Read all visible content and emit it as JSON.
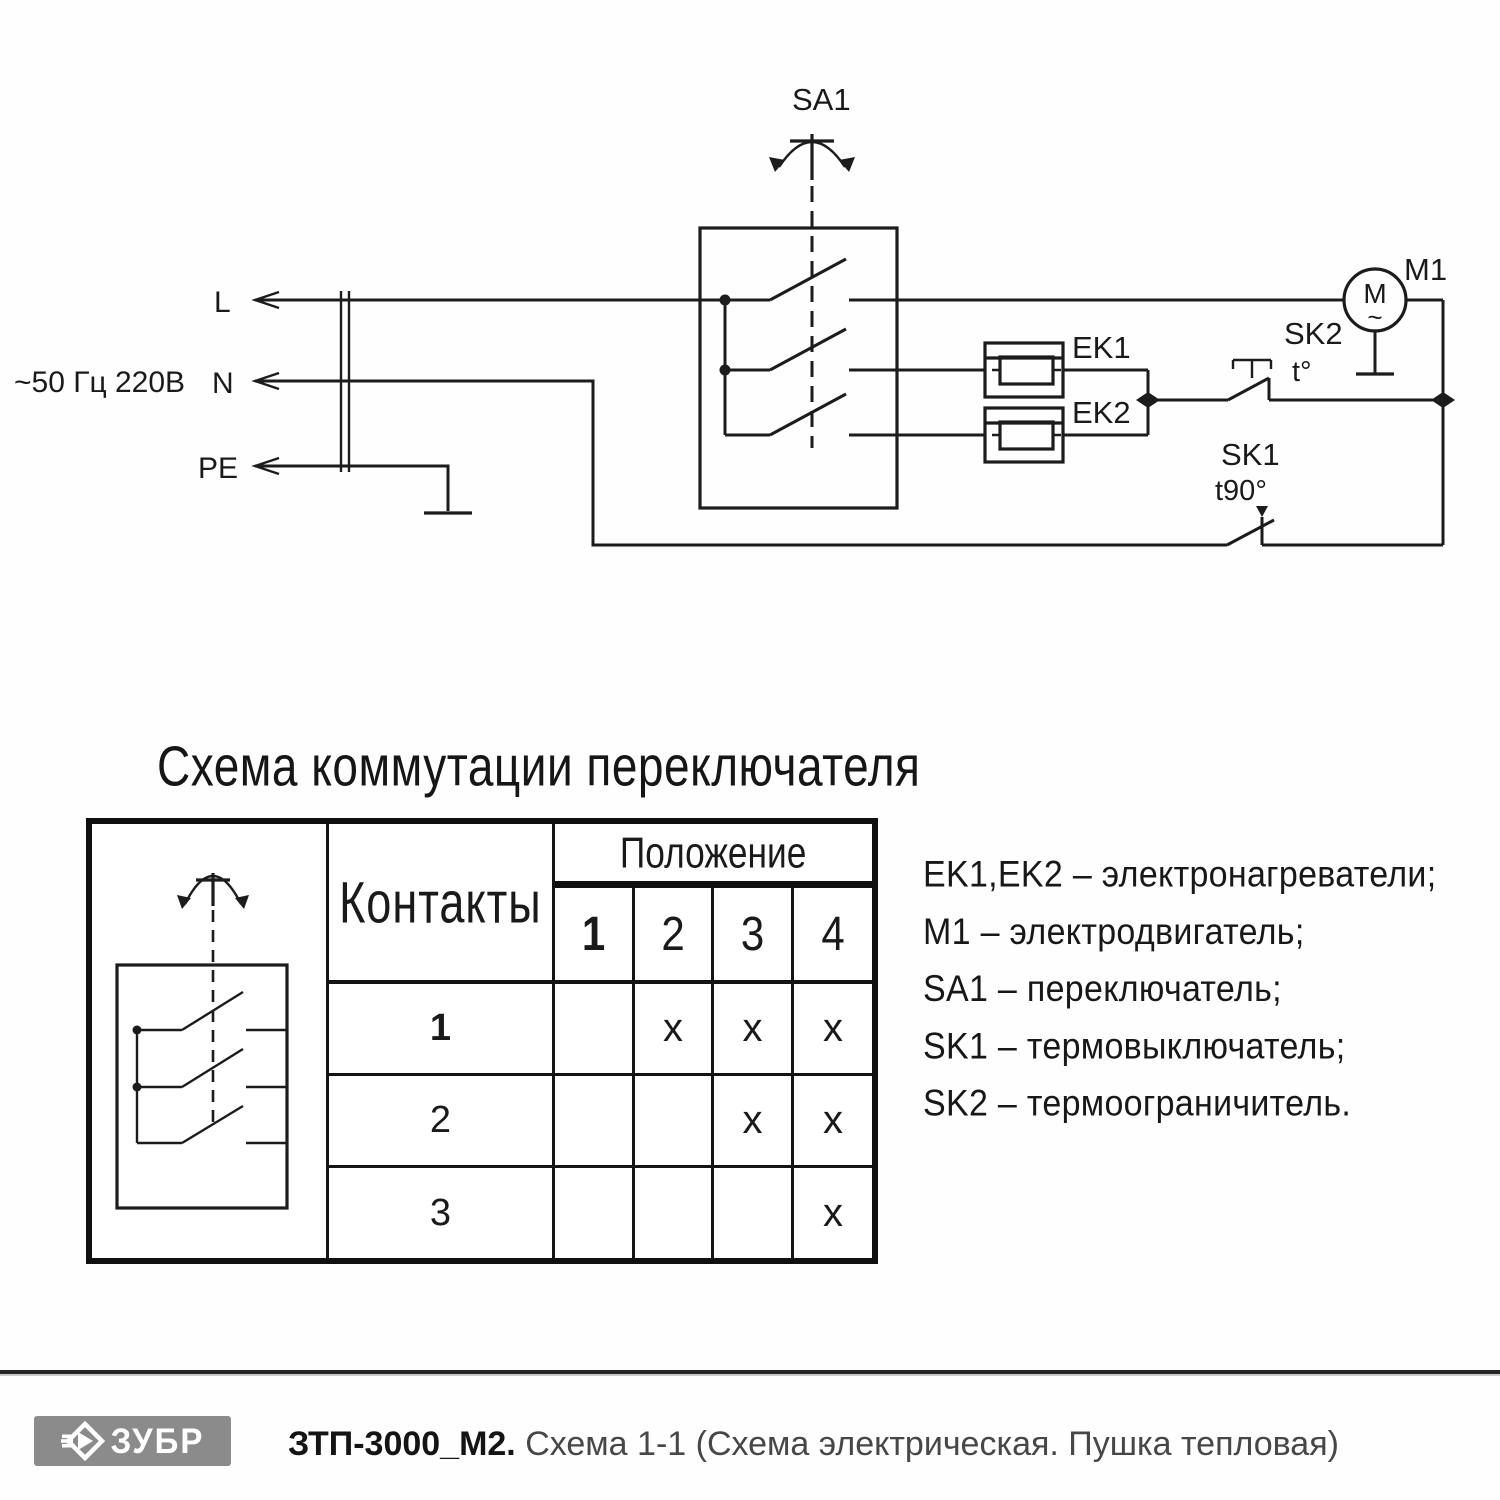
{
  "schematic": {
    "supply_label": "~50 Гц 220В",
    "terminals": {
      "l": "L",
      "n": "N",
      "pe": "PE"
    },
    "switch": {
      "label": "SA1"
    },
    "heaters": {
      "ek1": "EK1",
      "ek2": "EK2"
    },
    "motor": {
      "label": "M1",
      "symbol": "M",
      "wave": "~"
    },
    "thermal_limiter": {
      "label": "SK2",
      "temp": "t°"
    },
    "thermal_cutout": {
      "label": "SK1",
      "temp": "t90°"
    }
  },
  "switch_table": {
    "title": "Схема коммутации переключателя",
    "contacts_header": "Контакты",
    "position_header": "Положение",
    "positions": [
      "1",
      "2",
      "3",
      "4"
    ],
    "rows": [
      {
        "contact": "1",
        "marks": [
          "",
          "x",
          "x",
          "x"
        ]
      },
      {
        "contact": "2",
        "marks": [
          "",
          "",
          "x",
          "x"
        ]
      },
      {
        "contact": "3",
        "marks": [
          "",
          "",
          "",
          "x"
        ]
      }
    ]
  },
  "legend": {
    "items": [
      "EK1,EK2 – электронагреватели;",
      "M1 – электродвигатель;",
      "SA1 – переключатель;",
      "SK1 – термовыключатель;",
      "SK2 – термоограничитель."
    ]
  },
  "footer": {
    "brand": "ЗУБР",
    "model": "ЗТП-3000_М2.",
    "subtitle": "Схема 1-1 (Схема электрическая. Пушка тепловая)"
  },
  "colors": {
    "line": "#1c1c1c",
    "logo_gray": "#8b8b8b"
  }
}
